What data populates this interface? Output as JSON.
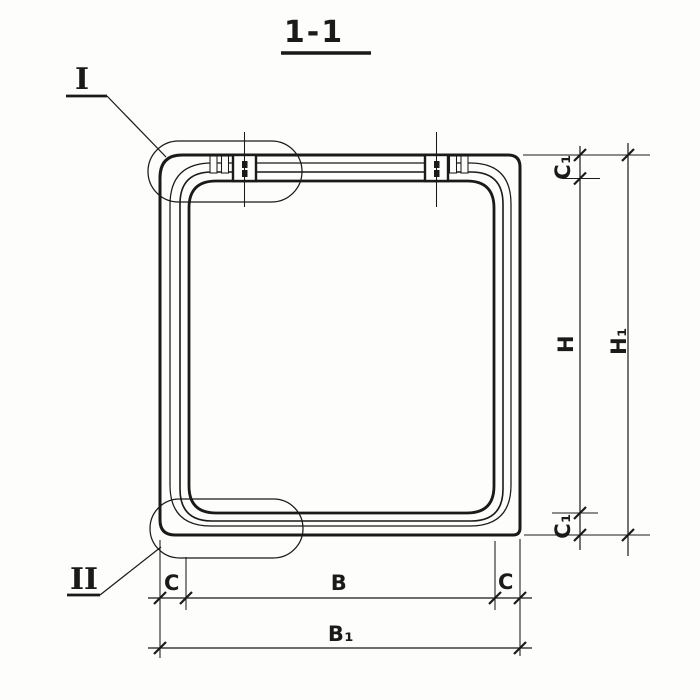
{
  "title": {
    "text": "1-1"
  },
  "details": [
    {
      "label": "I"
    },
    {
      "label": "II"
    }
  ],
  "dimensions": {
    "right": [
      {
        "label": "C₁"
      },
      {
        "label": "H"
      },
      {
        "label": "C₁"
      },
      {
        "label": "H₁"
      }
    ],
    "bottom": [
      {
        "label": "C"
      },
      {
        "label": "B"
      },
      {
        "label": "C"
      },
      {
        "label": "B₁"
      }
    ]
  },
  "colors": {
    "ink": "#1a1a1a",
    "paper": "#fdfdfc"
  }
}
